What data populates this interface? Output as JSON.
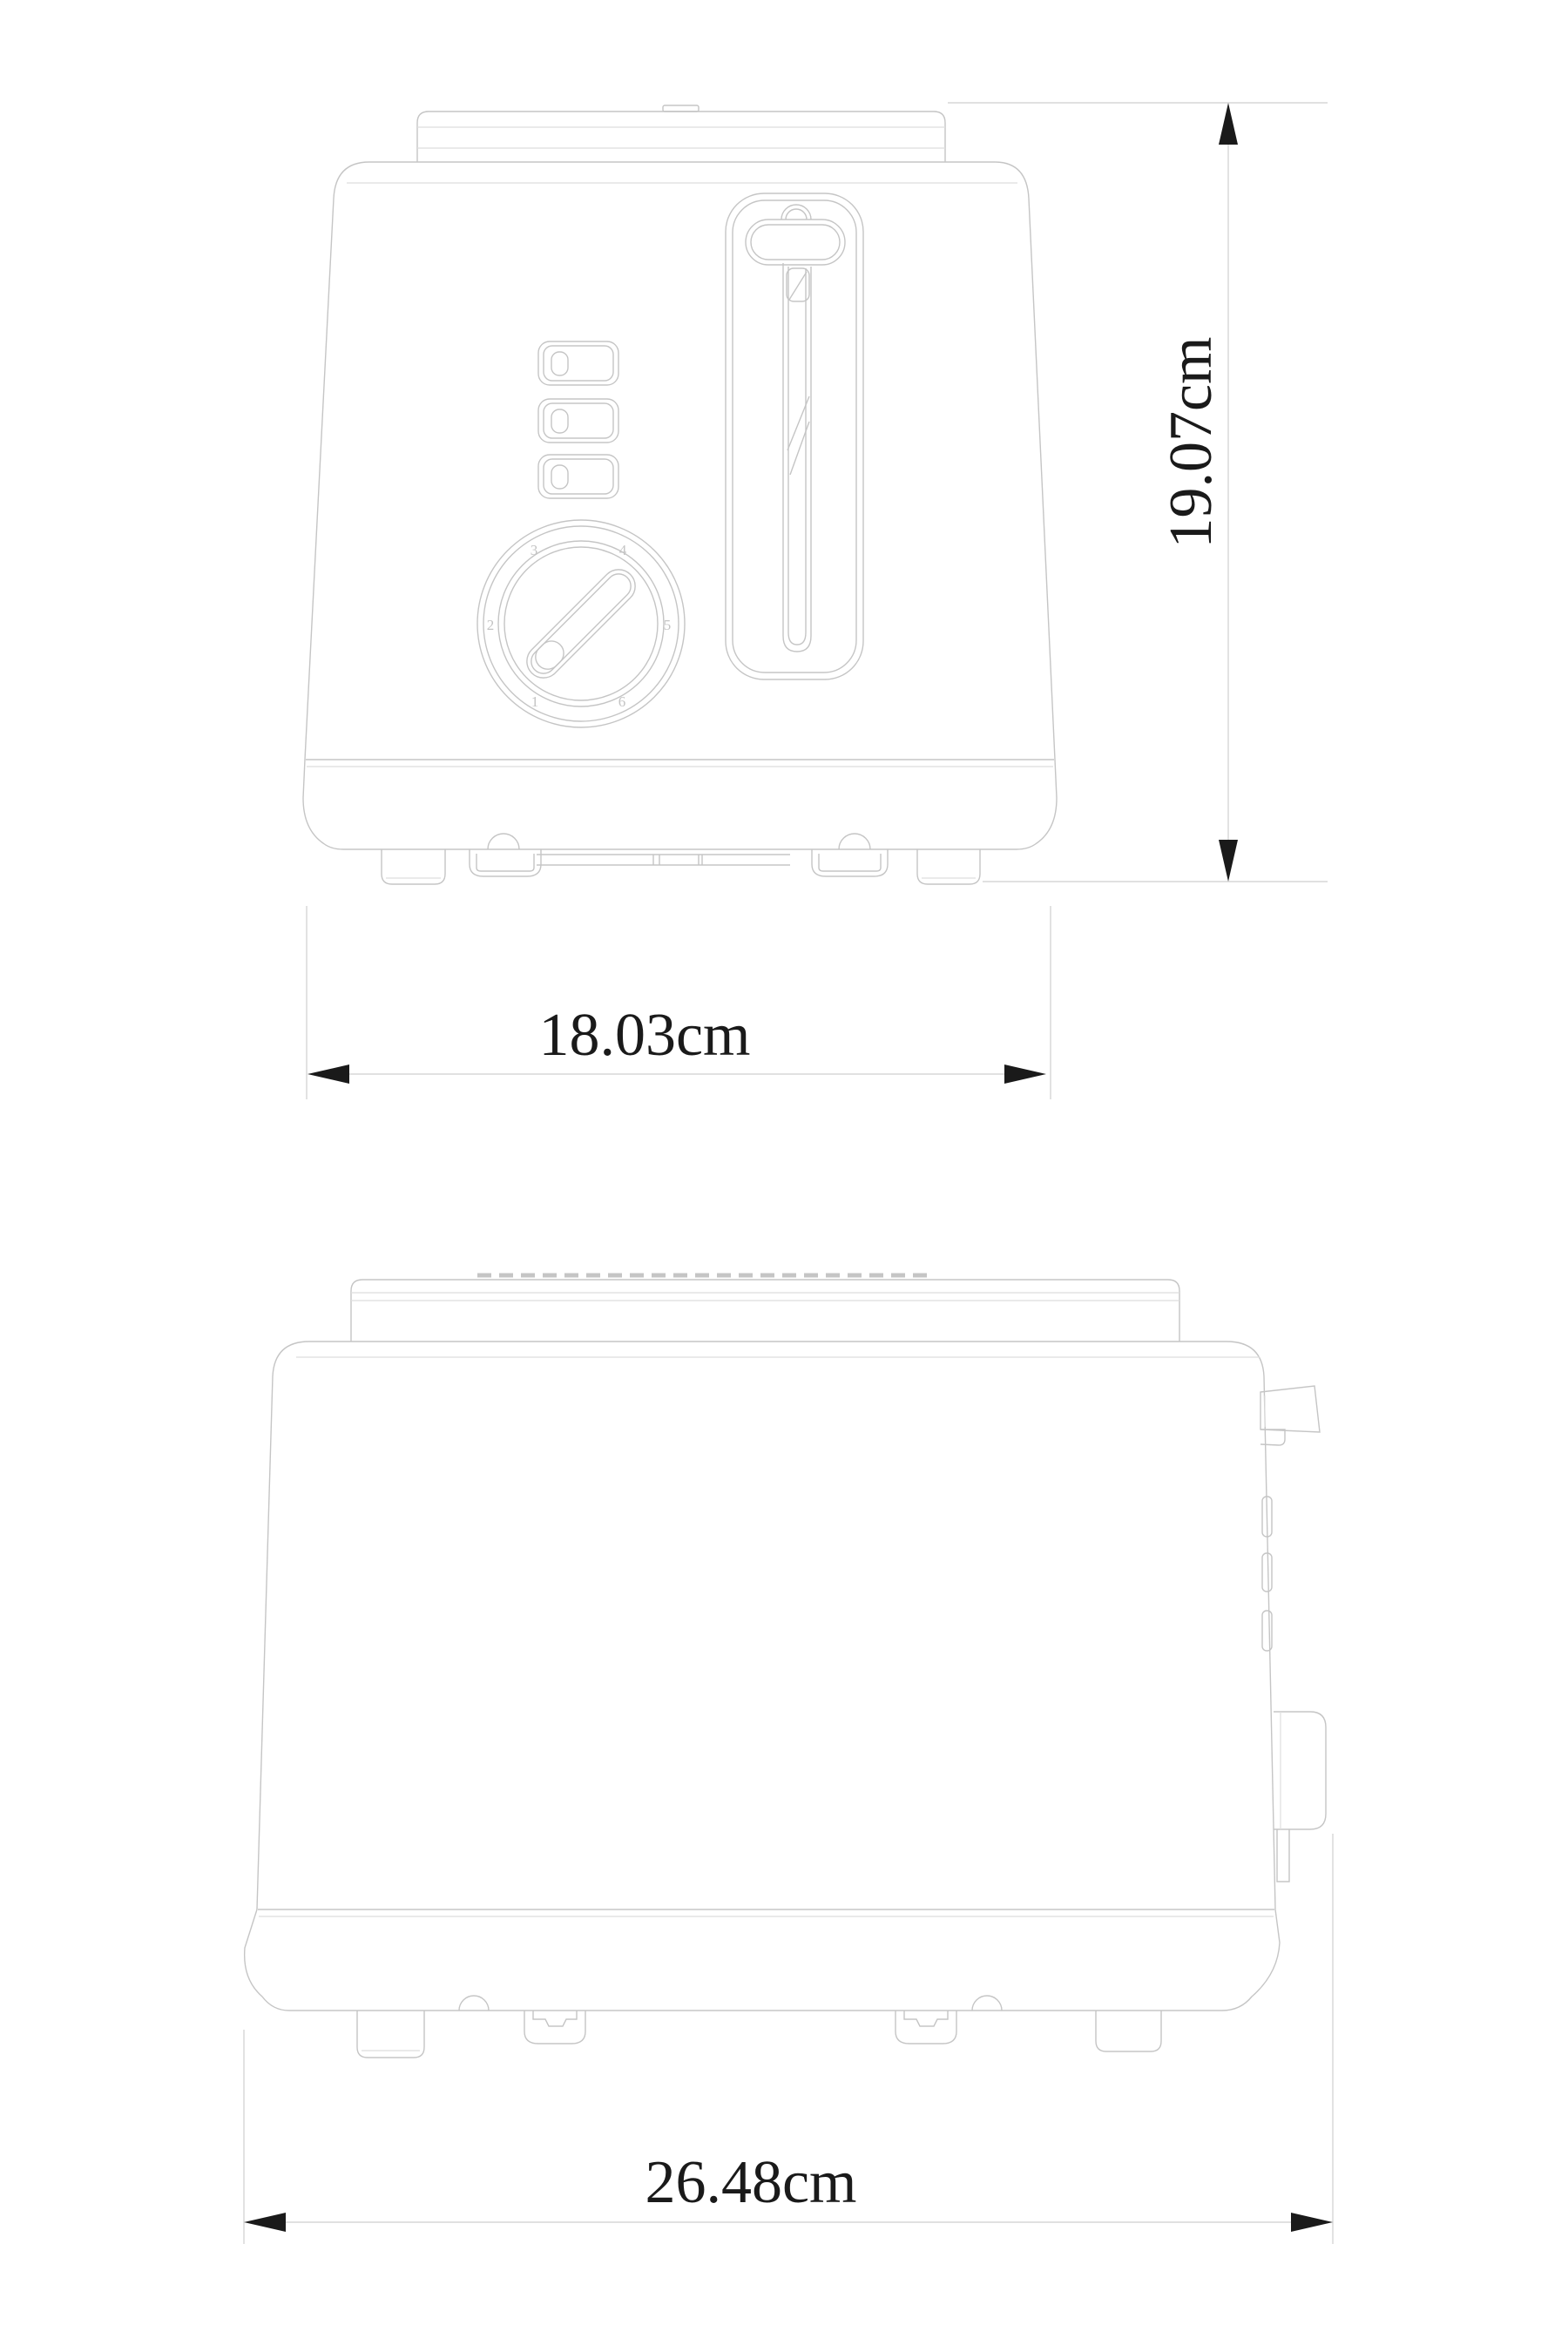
{
  "drawing": {
    "type": "technical-dimension-drawing",
    "subject": "two-slice toaster, front and side orthographic views",
    "dimension_labels": {
      "height": "19.07cm",
      "width": "18.03cm",
      "depth": "26.48cm"
    },
    "dial": {
      "numbers": [
        "1",
        "2",
        "3",
        "4",
        "5",
        "6"
      ]
    },
    "colors": {
      "outline": "#c5c5c5",
      "outline_light": "#dedede",
      "dim_line": "#cfcfcf",
      "dim_ink": "#1a1a1a",
      "dial_number": "#c4c4c4",
      "background": "#ffffff"
    }
  }
}
